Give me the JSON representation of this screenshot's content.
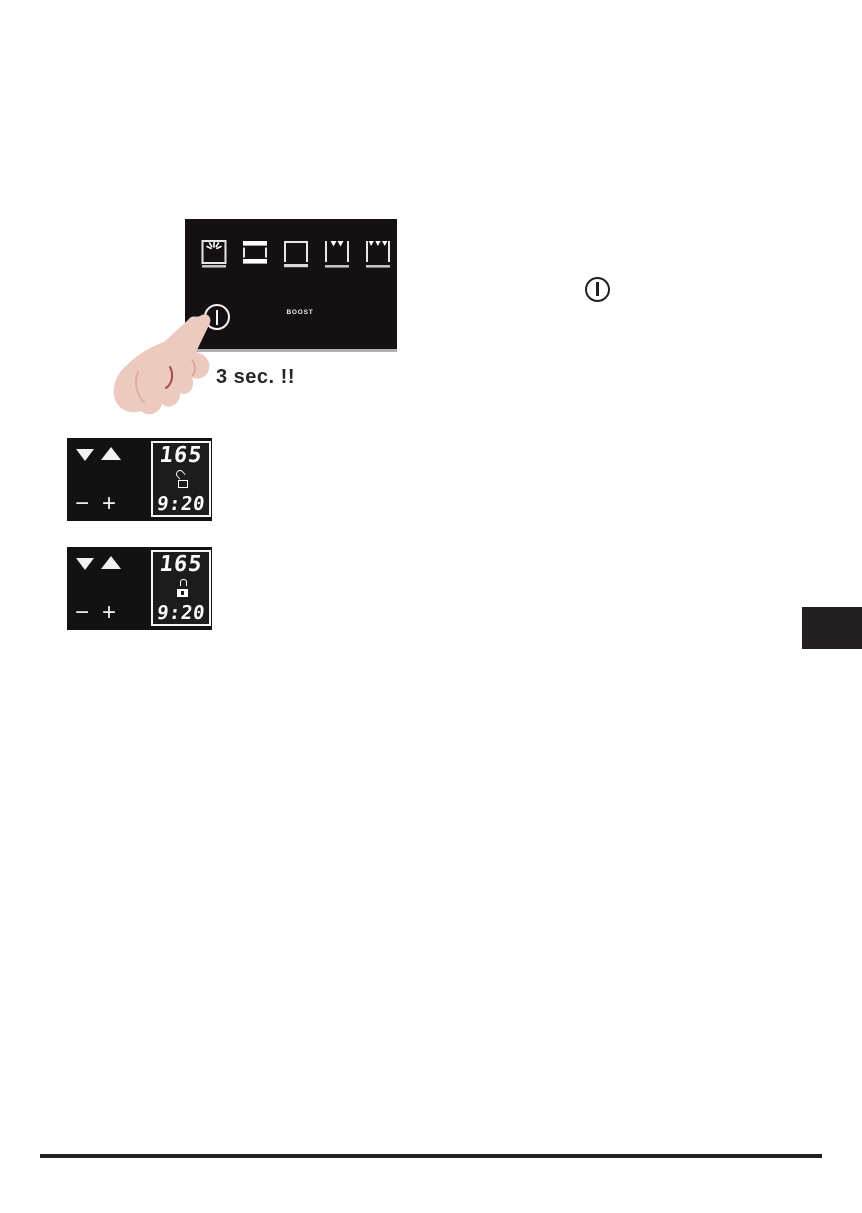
{
  "document": {
    "caption": "3 sec. !!",
    "control_panel": {
      "boost_label": "BOOST",
      "power_symbol": "power",
      "function_icons": [
        {
          "name": "oven-lamp-icon"
        },
        {
          "name": "top-and-bottom-heat-icon"
        },
        {
          "name": "bottom-heat-icon"
        },
        {
          "name": "grill-icon"
        },
        {
          "name": "large-grill-icon"
        }
      ]
    },
    "inline_power_symbol": "power",
    "displays": [
      {
        "temperature": "165",
        "time": "9:20",
        "lock_state": "unlocked",
        "minus_label": "−",
        "plus_label": "+"
      },
      {
        "temperature": "165",
        "time": "9:20",
        "lock_state": "locked",
        "minus_label": "−",
        "plus_label": "+"
      }
    ],
    "colors": {
      "panel_background": "#151113",
      "display_background": "#121212",
      "ink": "#231f20",
      "skin_tone": "#edcabf"
    }
  }
}
